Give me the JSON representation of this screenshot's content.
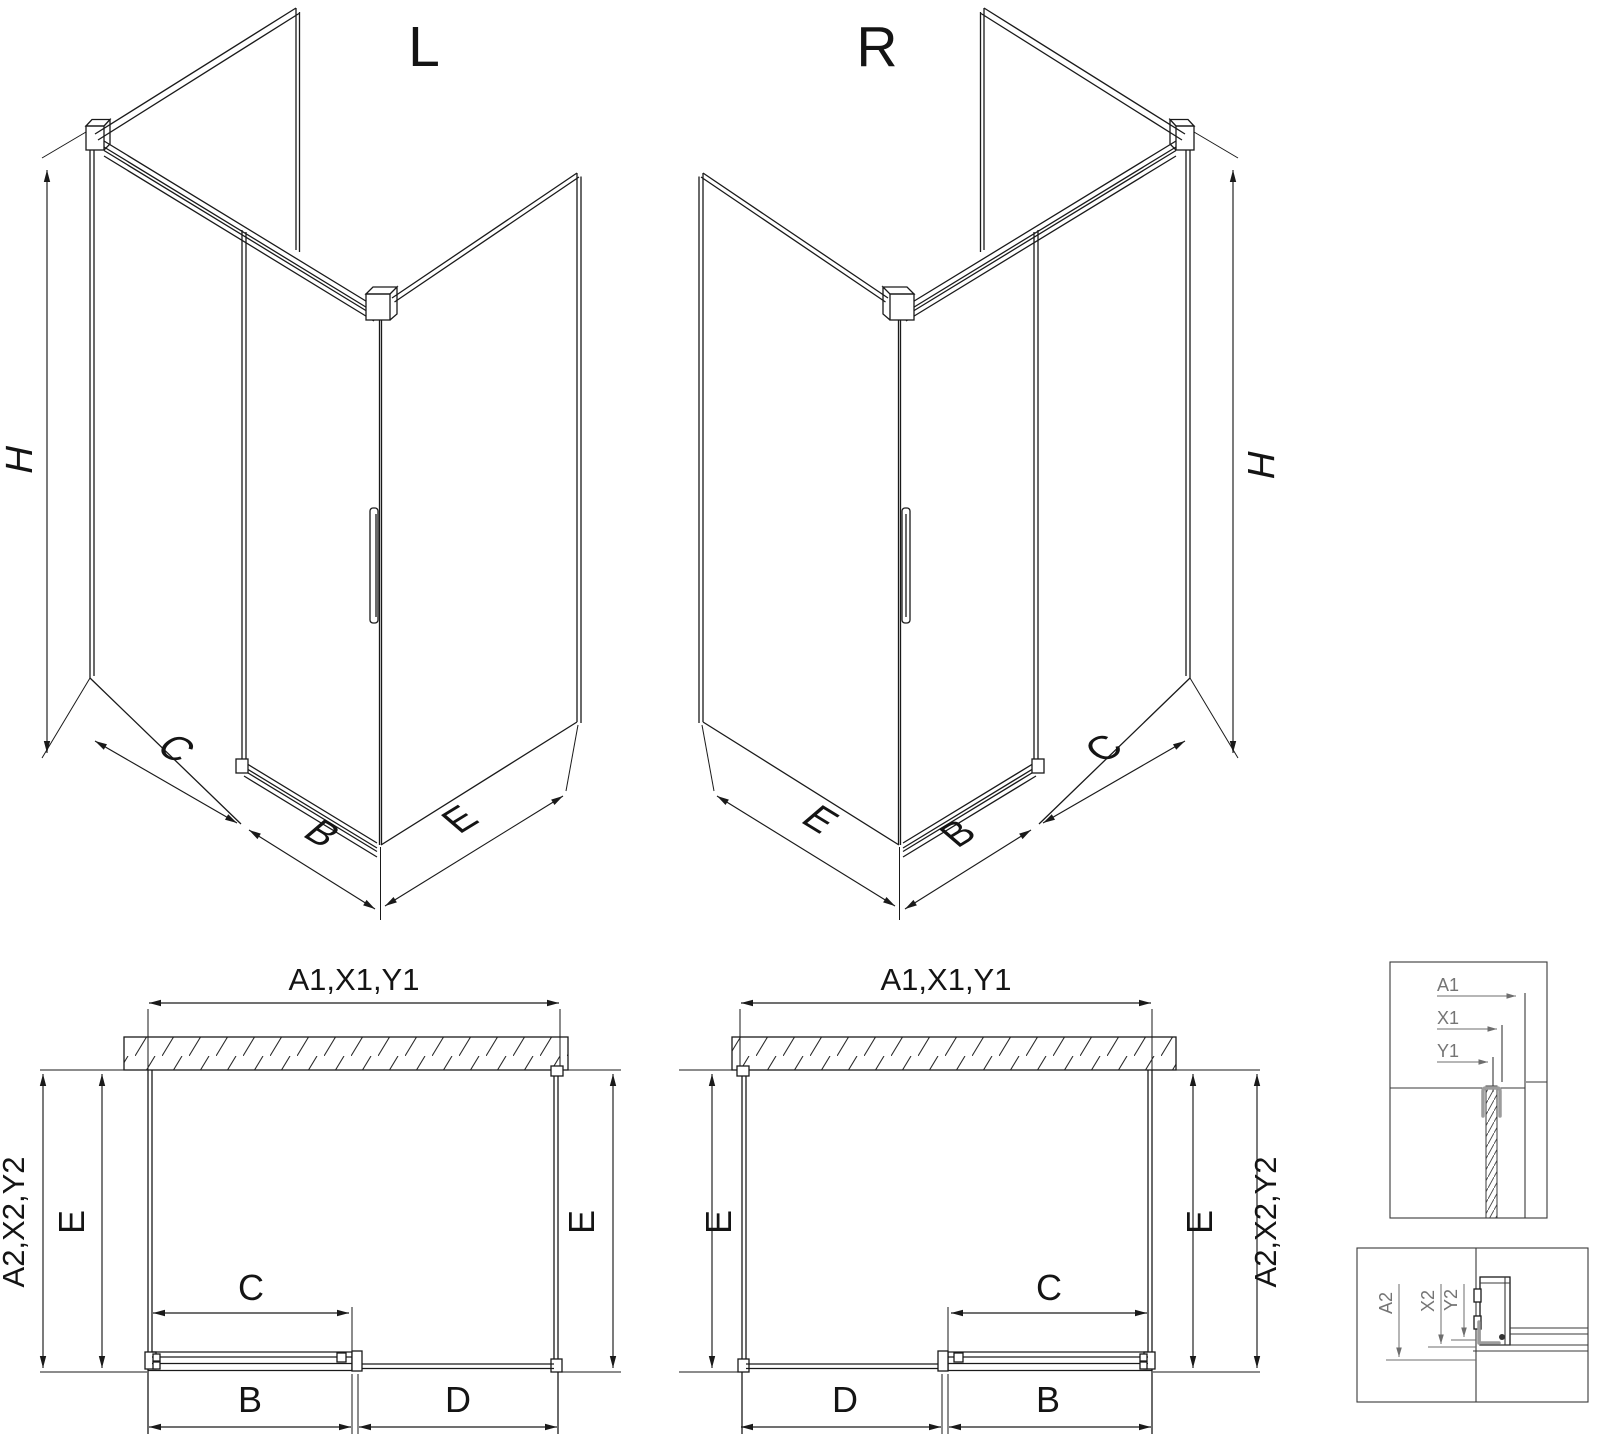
{
  "drawing": {
    "iso_left": {
      "title": "L",
      "height": "H",
      "fixed_width": "C",
      "door_width": "B",
      "side_width": "E"
    },
    "iso_right": {
      "title": "R",
      "height": "H",
      "fixed_width": "C",
      "door_width": "B",
      "side_width": "E"
    },
    "plan_left": {
      "total_width": "A1,X1,Y1",
      "total_depth": "A2,X2,Y2",
      "side_left": "E",
      "side_right": "E",
      "door_opening": "C",
      "door_panel": "B",
      "fixed_panel": "D"
    },
    "plan_right": {
      "total_width": "A1,X1,Y1",
      "total_depth": "A2,X2,Y2",
      "side_left": "E",
      "side_right": "E",
      "door_opening": "C",
      "door_panel": "B",
      "fixed_panel": "D"
    },
    "detail_wall_section": {
      "dim_a": "A1",
      "dim_x": "X1",
      "dim_y": "Y1"
    },
    "detail_floor_section": {
      "dim_a": "A2",
      "dim_x": "X2",
      "dim_y": "Y2"
    },
    "colors": {
      "line": "#1a1a1a",
      "detail_dim": "#6e6e6e",
      "profile_gray": "#9c9c9c",
      "background": "#ffffff"
    }
  }
}
